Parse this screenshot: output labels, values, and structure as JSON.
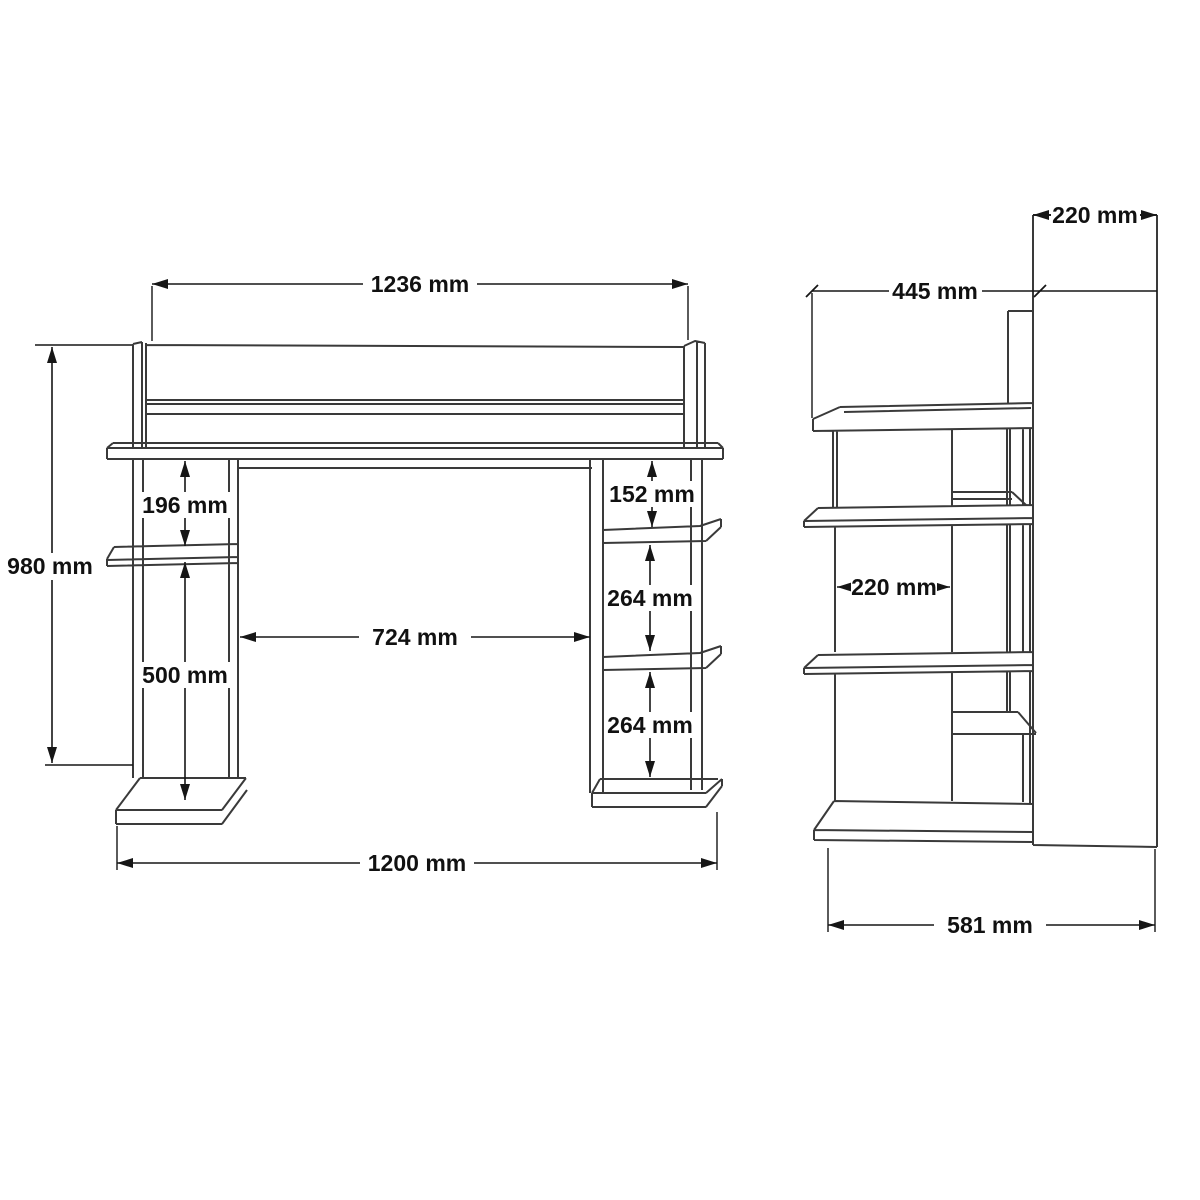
{
  "drawing": {
    "title": "desk-technical-drawing",
    "unit": "mm",
    "colors": {
      "background": "#ffffff",
      "object_line": "#3a3a3a",
      "dimension_line": "#161616",
      "text": "#111111"
    },
    "front_view": {
      "name": "front-view",
      "dims": {
        "top_width": {
          "value": 1236,
          "label": "1236 mm"
        },
        "total_height": {
          "value": 980,
          "label": "980 mm"
        },
        "left_gap_upper": {
          "value": 196,
          "label": "196 mm"
        },
        "left_gap_lower": {
          "value": 500,
          "label": "500 mm"
        },
        "right_gap_top": {
          "value": 152,
          "label": "152 mm"
        },
        "right_gap_mid": {
          "value": 264,
          "label": "264 mm"
        },
        "right_gap_bottom": {
          "value": 264,
          "label": "264 mm"
        },
        "opening_width": {
          "value": 724,
          "label": "724 mm"
        },
        "bottom_width": {
          "value": 1200,
          "label": "1200 mm"
        }
      }
    },
    "side_view": {
      "name": "side-view",
      "dims": {
        "back_panel_depth": {
          "value": 220,
          "label": "220 mm"
        },
        "desktop_depth": {
          "value": 445,
          "label": "445 mm"
        },
        "shelf_depth": {
          "value": 220,
          "label": "220 mm"
        },
        "total_depth": {
          "value": 581,
          "label": "581 mm"
        }
      }
    }
  }
}
